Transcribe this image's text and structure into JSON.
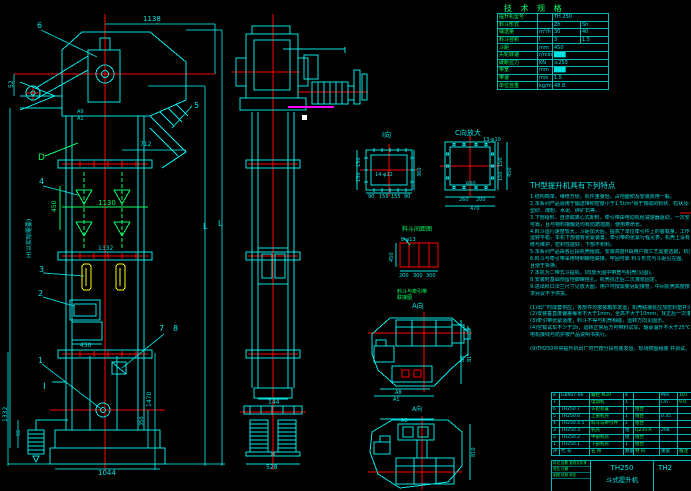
{
  "colors": {
    "bg": "#000000",
    "cyan": "#00e5e5",
    "green": "#00ff66",
    "red": "#ff0000",
    "yellow": "#ffff00",
    "magenta": "#ff00ff",
    "white": "#ffffff",
    "grid": "#00b8b8"
  },
  "spec": {
    "title": "技 术 规 格",
    "rows": [
      {
        "l": "提升机型号",
        "u": "",
        "a": "TH 250",
        "b": "",
        "span": true
      },
      {
        "l": "料斗形式",
        "u": "",
        "a": "Zh",
        "b": "Sh"
      },
      {
        "l": "输送量",
        "u": "m³/h",
        "a": "30",
        "b": "40"
      },
      {
        "l": "料斗容积",
        "u": "l",
        "a": "3",
        "b": "1.5"
      },
      {
        "l": "斗距",
        "u": "mm",
        "a": "450",
        "b": "",
        "span": true
      },
      {
        "l": "头轮转速",
        "u": "r/min",
        "a": "███",
        "b": "",
        "span": true
      },
      {
        "l": "破断拉力",
        "u": "KN",
        "a": "≥250",
        "b": "",
        "span": true
      },
      {
        "l": "带宽",
        "u": "mm",
        "a": "███",
        "b": "",
        "span": true
      },
      {
        "l": "带速",
        "u": "m/s",
        "a": "1.5",
        "b": "",
        "span": true
      },
      {
        "l": "单位自重",
        "u": "kg/m",
        "a": "48.8",
        "b": "",
        "span": true
      }
    ]
  },
  "notes": {
    "title": "TH型提升机具有下列特点",
    "lines": [
      "1.结构简单，维修方便，机件重量轻，占地面积及安装费用一般。",
      "2.本系列产品适用于输送堆积密度小于1.5t/m³易于掏取的粉状、粒状及小块状物料，如谷物、",
      "  型砂、煤粉、水泥、碎矿石等。",
      "3.下部给料，自流或离心式卸料，牵引带由电动机经减速器驱动，一次安装后不需调整，方便",
      "  可靠，且与物料接触处均有防磨措施，使用寿命长。",
      "4.料斗运行速度较大，斗距加大后，提高了单位牵引件上的装载量，工作时物料的翻落减少，",
      "  运转平稳。本机下部装有张紧装置，牵引带的张紧行程见表，机壳上设有检视门，便于检",
      "  修与维护，密封性能好，下部不积料。",
      "5.本系列产品由各区段机壳组成，安装高度H由用户按工艺需要选取，机壳区段另配。",
      "6.料斗与牵引带采用特制螺栓联接，牢固可靠                料斗形式与斗距见左图。",
      "  且便于拆换。",
      "7.本机为二带式斗提机，I向放大图中带宽与机壳(见图)。",
      "8.安装时基础预留地脚螺栓孔，机壳找正后二次灌浆固定。",
      "9.进出料口法兰尺寸见放大图，用户可按需要另配接管，中间机壳高度按标准节组合，特殊要",
      "  求另议不予供货。",
      "",
      "(1)出厂时成套供应，各部件均按装箱单发运，机壳联接处应加密封垫并涂密封胶。",
      "(2)安装垂直度偏差每米不大于1mm，全高不大于10mm，找正后一次灌浆。",
      "(3)牵引带张紧适度，料斗不得与机壳相碰，运转方向见图示。",
      "(4)空载试车不少于2h，运转正常后方可带料试车，轴承温升不大于25℃，ACI.Y系列",
      "  电机接线与防护按产品说明书执行。",
      "",
      "(9)TH250中央提升机出厂时已按分段包装发运，现场按图组装 并调试。"
    ]
  },
  "bom": {
    "rows": [
      [
        "8",
        "GB907-86",
        "螺栓 M20",
        "4",
        "",
        "Mm",
        "10T"
      ],
      [
        "7",
        "",
        "电动机",
        "1",
        "",
        "Lm",
        "9.0"
      ],
      [
        "6",
        "TH250.7",
        "头轮装置",
        "1",
        "组合",
        "",
        ""
      ],
      [
        "5",
        "TH250.6",
        "上部机壳",
        "1",
        "组合",
        "0.35",
        ""
      ],
      [
        "4",
        "TH250.4.5",
        "料斗与牵引件",
        "1",
        "组合",
        "",
        ""
      ],
      [
        "3",
        "TH250.3",
        "机壳",
        "组",
        "Q235-A",
        "208",
        ""
      ],
      [
        "2",
        "TH250.2",
        "中部机壳",
        "组",
        "组合",
        "",
        ""
      ],
      [
        "1",
        "TH250.1",
        "下部机壳",
        "1",
        "组合",
        "",
        ""
      ],
      [
        "序",
        "代 号",
        "名 称",
        "数量",
        "材 料",
        "重量",
        "备注"
      ]
    ]
  },
  "tb": {
    "model": "TH250",
    "name": "斗式提升机",
    "partial": "TH2",
    "row1": "标记 处数 更改文件号",
    "row2": "签名  日期",
    "row3": "制图  校核  审定"
  },
  "annotations": [
    {
      "n": "balloon-6",
      "x": 37,
      "y": 28,
      "t": "6",
      "c": "cy",
      "s": 8
    },
    {
      "n": "dim-1138",
      "x": 143,
      "y": 21,
      "t": "1138",
      "c": "cy",
      "s": 7
    },
    {
      "n": "dim-52",
      "x": 13,
      "y": 88,
      "t": "52",
      "c": "cy",
      "s": 6,
      "r": -90
    },
    {
      "n": "dim-a9",
      "x": 77,
      "y": 113,
      "t": "A9",
      "c": "cy",
      "s": 5
    },
    {
      "n": "dim-a1",
      "x": 77,
      "y": 120,
      "t": "A1",
      "c": "cy",
      "s": 5
    },
    {
      "n": "balloon-5",
      "x": 194,
      "y": 108,
      "t": "5",
      "c": "cy",
      "s": 8
    },
    {
      "n": "label-d",
      "x": 38,
      "y": 160,
      "t": "D",
      "c": "gr",
      "s": 9
    },
    {
      "n": "dim-712",
      "x": 140,
      "y": 146,
      "t": "712",
      "c": "cy",
      "s": 6
    },
    {
      "n": "balloon-4",
      "x": 39,
      "y": 184,
      "t": "4",
      "c": "cy",
      "s": 8
    },
    {
      "n": "dim-450-buckets",
      "x": 56,
      "y": 212,
      "t": "450",
      "c": "gr",
      "s": 6,
      "r": -90
    },
    {
      "n": "dim-1130",
      "x": 98,
      "y": 205,
      "t": "1130",
      "c": "gr",
      "s": 7
    },
    {
      "n": "dim-1332-mid",
      "x": 98,
      "y": 250,
      "t": "1332",
      "c": "cy",
      "s": 6
    },
    {
      "n": "balloon-3",
      "x": 39,
      "y": 272,
      "t": "3",
      "c": "cy",
      "s": 8
    },
    {
      "n": "balloon-2",
      "x": 38,
      "y": 296,
      "t": "2",
      "c": "cy",
      "s": 8
    },
    {
      "n": "dim-450-door",
      "x": 80,
      "y": 347,
      "t": "450",
      "c": "cy",
      "s": 6
    },
    {
      "n": "balloon-7",
      "x": 159,
      "y": 331,
      "t": "7",
      "c": "cy",
      "s": 8
    },
    {
      "n": "balloon-8",
      "x": 173,
      "y": 331,
      "t": "8",
      "c": "cy",
      "s": 8
    },
    {
      "n": "balloon-1",
      "x": 38,
      "y": 363,
      "t": "1",
      "c": "cy",
      "s": 8
    },
    {
      "n": "label-section-i",
      "x": 43,
      "y": 389,
      "t": "I",
      "c": "cy",
      "s": 9
    },
    {
      "n": "dim-1470",
      "x": 151,
      "y": 407,
      "t": "1470",
      "c": "cy",
      "s": 6,
      "r": -90
    },
    {
      "n": "dim-350",
      "x": 143,
      "y": 426,
      "t": "350",
      "c": "cy",
      "s": 5,
      "r": -90
    },
    {
      "n": "dim-1332-left",
      "x": 7,
      "y": 422,
      "t": "1332",
      "c": "cy",
      "s": 6,
      "r": -90
    },
    {
      "n": "dim-55",
      "x": 20,
      "y": 436,
      "t": "55",
      "c": "cy",
      "s": 5,
      "r": -90
    },
    {
      "n": "dim-1044",
      "x": 98,
      "y": 475,
      "t": "1044",
      "c": "cy",
      "s": 7
    },
    {
      "n": "label-h",
      "x": 31,
      "y": 258,
      "t": "H(以实际需要)",
      "c": "cy",
      "s": 6,
      "r": -90
    },
    {
      "n": "label-l1",
      "x": 203,
      "y": 229,
      "t": "L",
      "c": "cy",
      "s": 8
    },
    {
      "n": "label-l2",
      "x": 218,
      "y": 226,
      "t": "L",
      "c": "cy",
      "s": 8
    },
    {
      "n": "dim-144",
      "x": 268,
      "y": 404,
      "t": "144",
      "c": "cy",
      "s": 6
    },
    {
      "n": "dim-528",
      "x": 266,
      "y": 469,
      "t": "528",
      "c": "cy",
      "s": 6
    },
    {
      "n": "label-view-i",
      "x": 382,
      "y": 137,
      "t": "I向",
      "c": "cy",
      "s": 7
    },
    {
      "n": "dim-i-150a",
      "x": 360,
      "y": 167,
      "t": "150",
      "c": "cy",
      "s": 5,
      "r": -90
    },
    {
      "n": "dim-i-150b",
      "x": 360,
      "y": 182,
      "t": "150",
      "c": "cy",
      "s": 5,
      "r": -90
    },
    {
      "n": "dim-i-360",
      "x": 421,
      "y": 177,
      "t": "360",
      "c": "cy",
      "s": 5,
      "r": -90
    },
    {
      "n": "label-i-holes",
      "x": 375,
      "y": 176,
      "t": "14-φ12",
      "c": "cy",
      "s": 5
    },
    {
      "n": "dim-i-90a",
      "x": 368,
      "y": 198,
      "t": "90",
      "c": "cy",
      "s": 5
    },
    {
      "n": "dim-i-155a",
      "x": 379,
      "y": 198,
      "t": "155",
      "c": "cy",
      "s": 5
    },
    {
      "n": "dim-i-155b",
      "x": 391,
      "y": 198,
      "t": "155",
      "c": "cy",
      "s": 5
    },
    {
      "n": "dim-i-90b",
      "x": 404,
      "y": 198,
      "t": "90",
      "c": "cy",
      "s": 5
    },
    {
      "n": "label-view-c",
      "x": 455,
      "y": 135,
      "t": "C向放大",
      "c": "cy",
      "s": 7
    },
    {
      "n": "label-c-holes",
      "x": 483,
      "y": 141,
      "t": "13-φ10",
      "c": "cy",
      "s": 5
    },
    {
      "n": "dim-c-660",
      "x": 466,
      "y": 185,
      "t": "660",
      "c": "cy",
      "s": 5
    },
    {
      "n": "dim-c-150a",
      "x": 502,
      "y": 167,
      "t": "150",
      "c": "cy",
      "s": 5,
      "r": -90
    },
    {
      "n": "dim-c-150b",
      "x": 502,
      "y": 181,
      "t": "150",
      "c": "cy",
      "s": 5,
      "r": -90
    },
    {
      "n": "dim-c-450",
      "x": 511,
      "y": 177,
      "t": "450",
      "c": "cy",
      "s": 5,
      "r": -90
    },
    {
      "n": "dim-c-260",
      "x": 459,
      "y": 201,
      "t": "260",
      "c": "cy",
      "s": 5
    },
    {
      "n": "dim-c-200",
      "x": 476,
      "y": 201,
      "t": "200",
      "c": "cy",
      "s": 5
    },
    {
      "n": "dim-c-470",
      "x": 470,
      "y": 210,
      "t": "470",
      "c": "cy",
      "s": 5
    },
    {
      "n": "label-bucket-pitch",
      "x": 402,
      "y": 231,
      "t": "料斗间距图",
      "c": "gr",
      "s": 6
    },
    {
      "n": "label-8-holes",
      "x": 401,
      "y": 241,
      "t": "8-φ13",
      "c": "cy",
      "s": 5
    },
    {
      "n": "dim-bs-450",
      "x": 393,
      "y": 262,
      "t": "450",
      "c": "cy",
      "s": 5,
      "r": -90
    },
    {
      "n": "dim-bs-200",
      "x": 399,
      "y": 277,
      "t": "200",
      "c": "cy",
      "s": 5
    },
    {
      "n": "dim-bs-300a",
      "x": 413,
      "y": 277,
      "t": "300",
      "c": "cy",
      "s": 5
    },
    {
      "n": "dim-bs-300b",
      "x": 426,
      "y": 277,
      "t": "300",
      "c": "cy",
      "s": 5
    },
    {
      "n": "label-attach-1",
      "x": 397,
      "y": 293,
      "t": "料斗与牵引带",
      "c": "gr",
      "s": 5
    },
    {
      "n": "label-attach-2",
      "x": 397,
      "y": 299,
      "t": "联接图",
      "c": "gr",
      "s": 5
    },
    {
      "n": "label-view-a1",
      "x": 412,
      "y": 308,
      "t": "A向",
      "c": "cy",
      "s": 7
    },
    {
      "n": "dim-tva-a8",
      "x": 395,
      "y": 394,
      "t": "A8",
      "c": "cy",
      "s": 5
    },
    {
      "n": "dim-tva-a1",
      "x": 393,
      "y": 401,
      "t": "A1",
      "c": "cy",
      "s": 5
    },
    {
      "n": "dim-tva-86",
      "x": 464,
      "y": 362,
      "t": "86",
      "c": "cy",
      "s": 5,
      "r": -90
    },
    {
      "n": "dim-tva-81",
      "x": 471,
      "y": 362,
      "t": "81",
      "c": "cy",
      "s": 5,
      "r": -90
    },
    {
      "n": "label-view-a2",
      "x": 412,
      "y": 411,
      "t": "A向",
      "c": "cy",
      "s": 6
    },
    {
      "n": "dim-tvb-a6",
      "x": 401,
      "y": 422,
      "t": "A6",
      "c": "cy",
      "s": 5
    },
    {
      "n": "dim-tvb-810",
      "x": 475,
      "y": 457,
      "t": "810",
      "c": "cy",
      "s": 5,
      "r": -90
    }
  ]
}
